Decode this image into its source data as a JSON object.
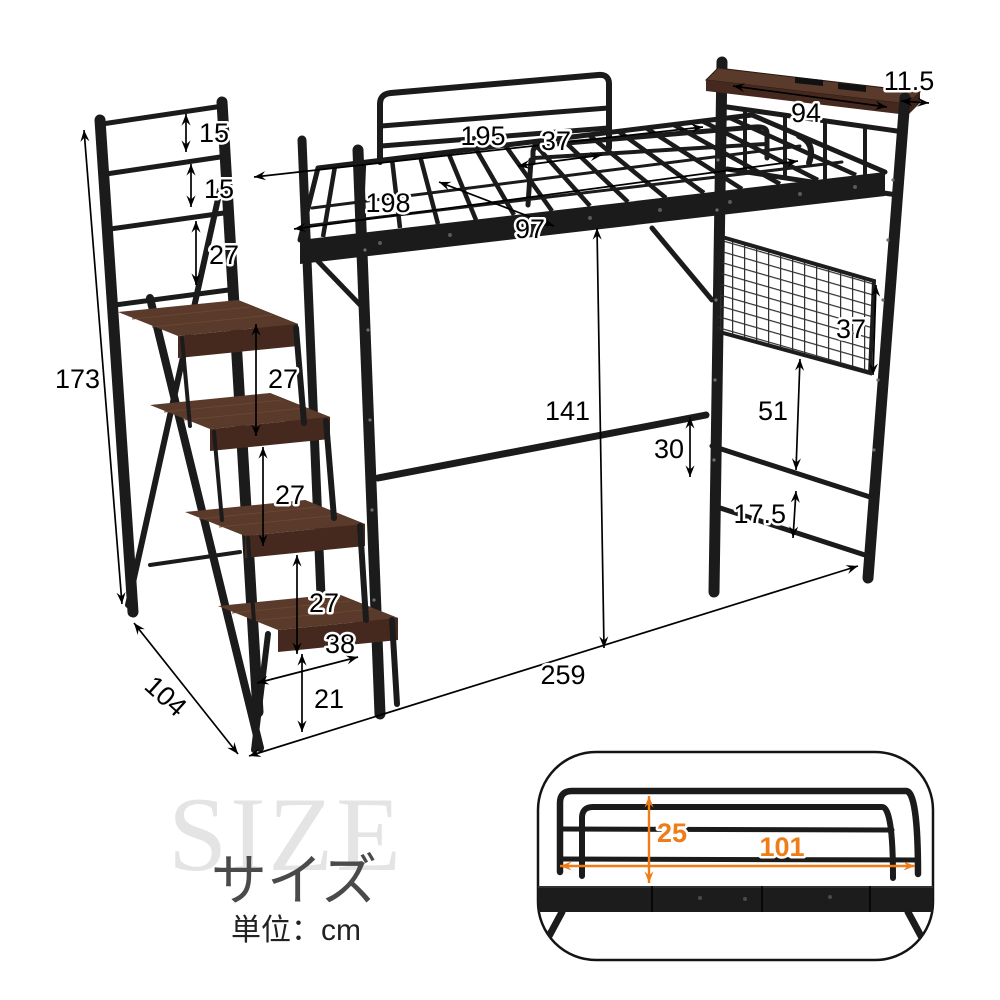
{
  "caption": {
    "watermark": "SIZE",
    "title_jp": "サイズ",
    "unit_note": "単位：cm"
  },
  "colors": {
    "frame_black": "#1b1b1b",
    "wood_brown": "#54362a",
    "dimension_black": "#000000",
    "accent_orange": "#ee7d18",
    "watermark_gray": "#e4e4e4",
    "title_gray": "#4a4a4a"
  },
  "dimensions_cm": {
    "handrail_gap_top": "15",
    "handrail_gap_mid": "15",
    "handrail_gap_bottom": "27",
    "overall_height": "173",
    "step_rise_upper": "27",
    "step_rise_middle": "27",
    "step_rise_lower": "27",
    "step_depth": "38",
    "bottom_step_height": "21",
    "stair_depth": "104",
    "overall_length": "259",
    "under_bed_clearance": "141",
    "bed_inner_length": "195",
    "guardrail_opening": "37",
    "bed_outer_length": "198",
    "bed_inner_width": "97",
    "headboard_shelf_width": "94",
    "headboard_shelf_depth": "11.5",
    "beam_to_crossbar": "30",
    "mesh_panel_height": "37",
    "mesh_to_crossbar": "51",
    "crossbar_spacing": "17.5"
  },
  "inset_detail": {
    "rail_height": "25",
    "rail_width": "101"
  }
}
